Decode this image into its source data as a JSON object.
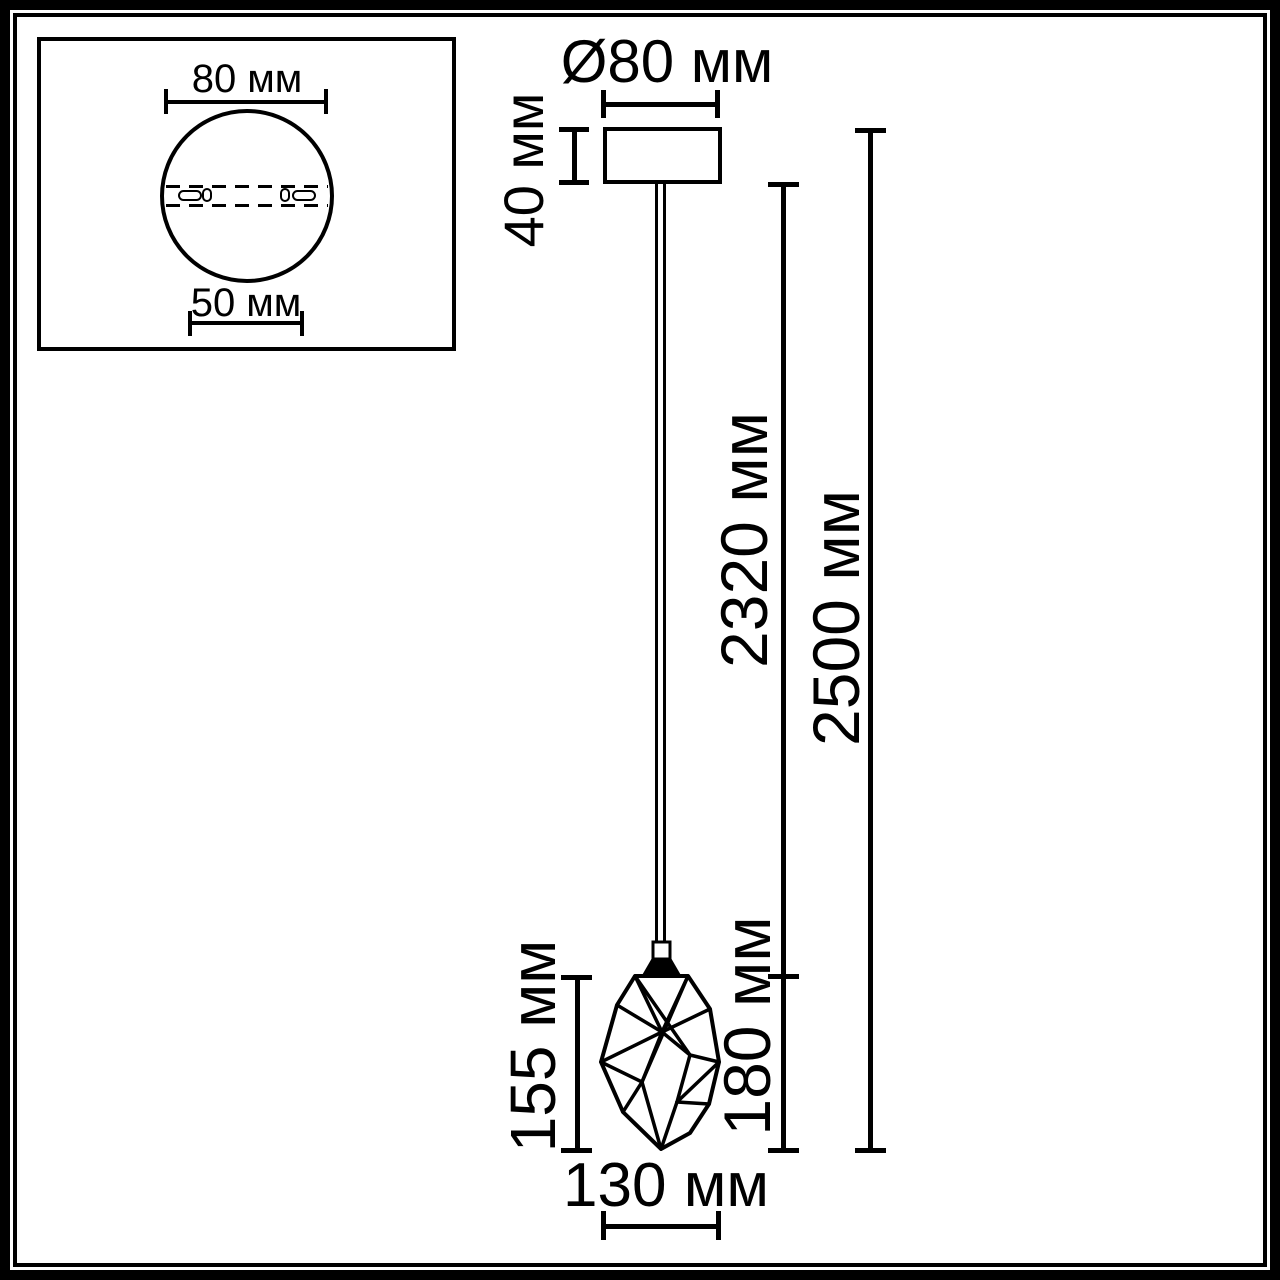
{
  "inset": {
    "top_dimension": "80 мм",
    "bottom_dimension": "50 мм"
  },
  "dims": {
    "canopy_diameter": "Ø80 мм",
    "canopy_height": "40 мм",
    "cord_length": "2320 мм",
    "total_height": "2500 мм",
    "shade_height": "155 мм",
    "shade_socket_height": "180 мм",
    "shade_width": "130 мм"
  },
  "colors": {
    "line": "#000000",
    "background": "#ffffff"
  }
}
